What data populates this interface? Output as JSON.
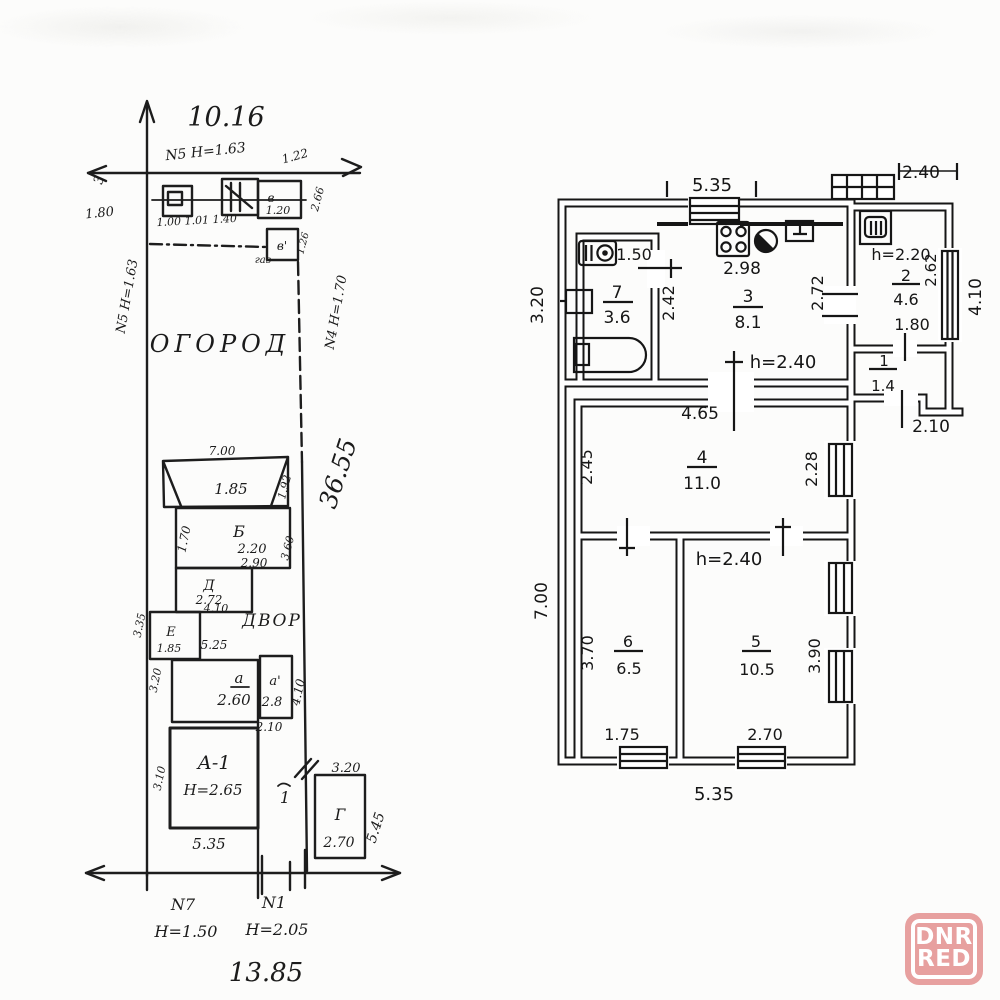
{
  "colors": {
    "ink": "#161616",
    "paper": "#fcfcfb",
    "watermark_pink": "#e7a09f",
    "watermark_text": "#ffffff"
  },
  "watermark": {
    "line1": "DNR",
    "line2": "RED"
  },
  "floor_plan": {
    "dim_top_width": "5.35",
    "dim_annex_top": "2.40",
    "dim_left_upper": "3.20",
    "dim_left_lower": "7.00",
    "dim_heater": "1.50",
    "room7": {
      "num": "7",
      "area": "3.6"
    },
    "dim_wall_7_3": "2.42",
    "dim_stove": "2.98",
    "room3": {
      "num": "3",
      "area": "8.1"
    },
    "dim_room3_right": "2.72",
    "height_main": "h=2.40",
    "height_annex": "h=2.20",
    "room2": {
      "num": "2",
      "area": "4.6"
    },
    "dim_annex_window": "2.62",
    "dim_room2_width": "1.80",
    "dim_annex_right": "4.10",
    "room1": {
      "num": "1",
      "area": "1.4"
    },
    "dim_annex_bottom": "2.10",
    "dim_room4_top": "4.65",
    "dim_room4_left": "2.45",
    "room4": {
      "num": "4",
      "area": "11.0"
    },
    "dim_room4_right": "2.28",
    "height_mid": "h=2.40",
    "dim_room6_left": "3.70",
    "room6": {
      "num": "6",
      "area": "6.5"
    },
    "room5": {
      "num": "5",
      "area": "10.5"
    },
    "dim_room5_right": "3.90",
    "dim_room6_bottom": "1.75",
    "dim_room5_bottom": "2.70",
    "dim_bottom_width": "5.35"
  },
  "site_plan": {
    "dim_top_width": "10.16",
    "marker_top": "N5 H=1.63",
    "dim_tick_top": "1.22",
    "dim_left_gate": "3",
    "dim_left_180": "1.80",
    "dims_row": "1.00 1.01 1.40",
    "shed_v": "в",
    "shed_v_dim": "1.20",
    "dim_right_266": "2.66",
    "dim_126": "1.26",
    "shed_v2": "в'",
    "gas_label": "газ",
    "garden_label": "ОГОРОД",
    "boundary_left": "N5 H=1.63",
    "boundary_right": "N4 H=1.70",
    "dim_right_length": "36.55",
    "shed1_width": "7.00",
    "shed1_h": "1.85",
    "shed1_right": "1.92",
    "bldg_b": "Б",
    "bldg_b_h": "2.20",
    "bldg_b_left": "1.70",
    "bldg_b_bottom": "2.90",
    "bldg_b_right": "3.60",
    "bldg_d": "Д",
    "bldg_d_h": "2.72",
    "dim_under_d": "4.10",
    "yard_label": "ДВОР",
    "bldg_e": "Е",
    "bldg_e_h": "1.85",
    "dim_e_right": "5.25",
    "dim_left_335": "3.35",
    "dim_left_320": "3.20",
    "dim_left_310": "3.10",
    "bldg_a": "а",
    "bldg_a_h": "2.60",
    "bldg_a2": "а'",
    "bldg_a2_h": "2.8",
    "dim_a2_bottom": "2.10",
    "dim_a2_right": "4.10",
    "house": "А-1",
    "house_h": "Н=2.65",
    "house_width": "5.35",
    "dim_gate_320": "3.20",
    "label_1": "1",
    "bldg_g": "Г",
    "bldg_g_h": "2.70",
    "dim_g_right": "5.45",
    "marker_n7": "N7",
    "marker_n7_h": "Н=1.50",
    "marker_n1": "N1",
    "marker_n1_h": "Н=2.05",
    "dim_bottom_width": "13.85"
  }
}
